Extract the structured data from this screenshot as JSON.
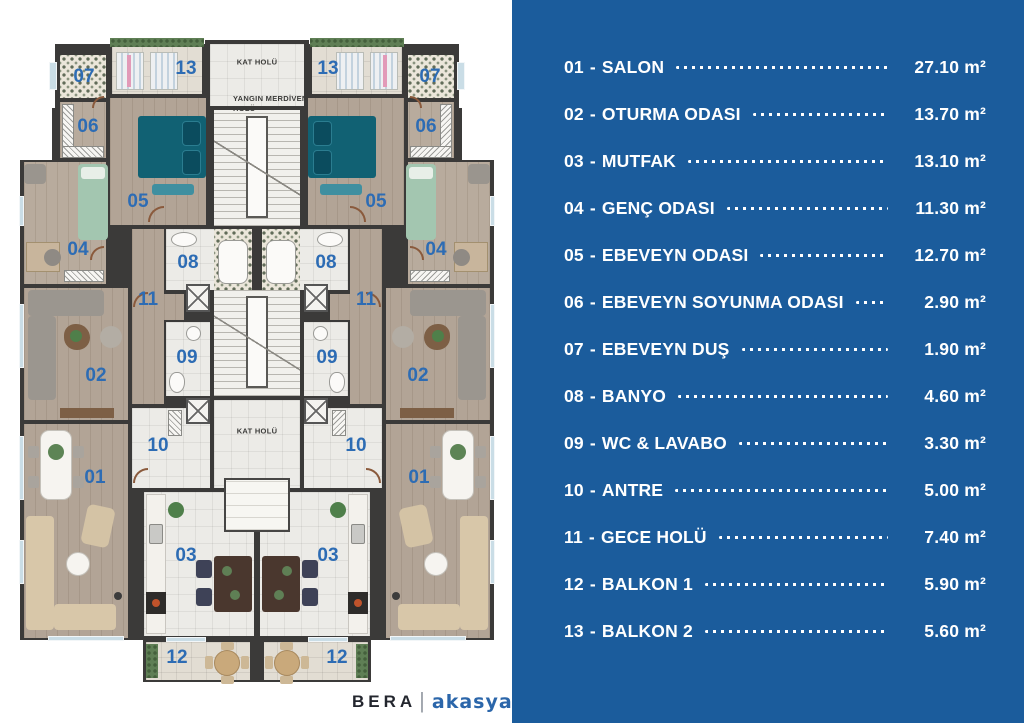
{
  "floorplan": {
    "labels": {
      "kat_holu_top": "KAT HOLÜ",
      "yangin_line1": "YANGIN MERDİVEN",
      "yangin_line2": "HOLÜ",
      "kat_holu_mid": "KAT HOLÜ"
    },
    "marker_color": "#2d6cb4",
    "wall_color": "#3b3a39"
  },
  "panel": {
    "bg_color": "#1b5c9c",
    "text_color": "#ffffff",
    "separator": "-",
    "items": [
      {
        "num": "01",
        "name": "SALON",
        "area": "27.10 m²"
      },
      {
        "num": "02",
        "name": "OTURMA ODASI",
        "area": "13.70 m²"
      },
      {
        "num": "03",
        "name": "MUTFAK",
        "area": "13.10 m²"
      },
      {
        "num": "04",
        "name": "GENÇ ODASI",
        "area": "11.30 m²"
      },
      {
        "num": "05",
        "name": "EBEVEYN ODASI",
        "area": "12.70 m²"
      },
      {
        "num": "06",
        "name": "EBEVEYN SOYUNMA ODASI",
        "area": "2.90 m²"
      },
      {
        "num": "07",
        "name": "EBEVEYN DUŞ",
        "area": "1.90 m²"
      },
      {
        "num": "08",
        "name": "BANYO",
        "area": "4.60 m²"
      },
      {
        "num": "09",
        "name": "WC & LAVABO",
        "area": "3.30 m²"
      },
      {
        "num": "10",
        "name": "ANTRE",
        "area": "5.00 m²"
      },
      {
        "num": "11",
        "name": "GECE HOLÜ",
        "area": "7.40 m²"
      },
      {
        "num": "12",
        "name": "BALKON 1",
        "area": "5.90 m²"
      },
      {
        "num": "13",
        "name": "BALKON 2",
        "area": "5.60 m²"
      }
    ]
  },
  "brand": {
    "name": "BERA",
    "divider": "|",
    "sub": "akasya"
  }
}
